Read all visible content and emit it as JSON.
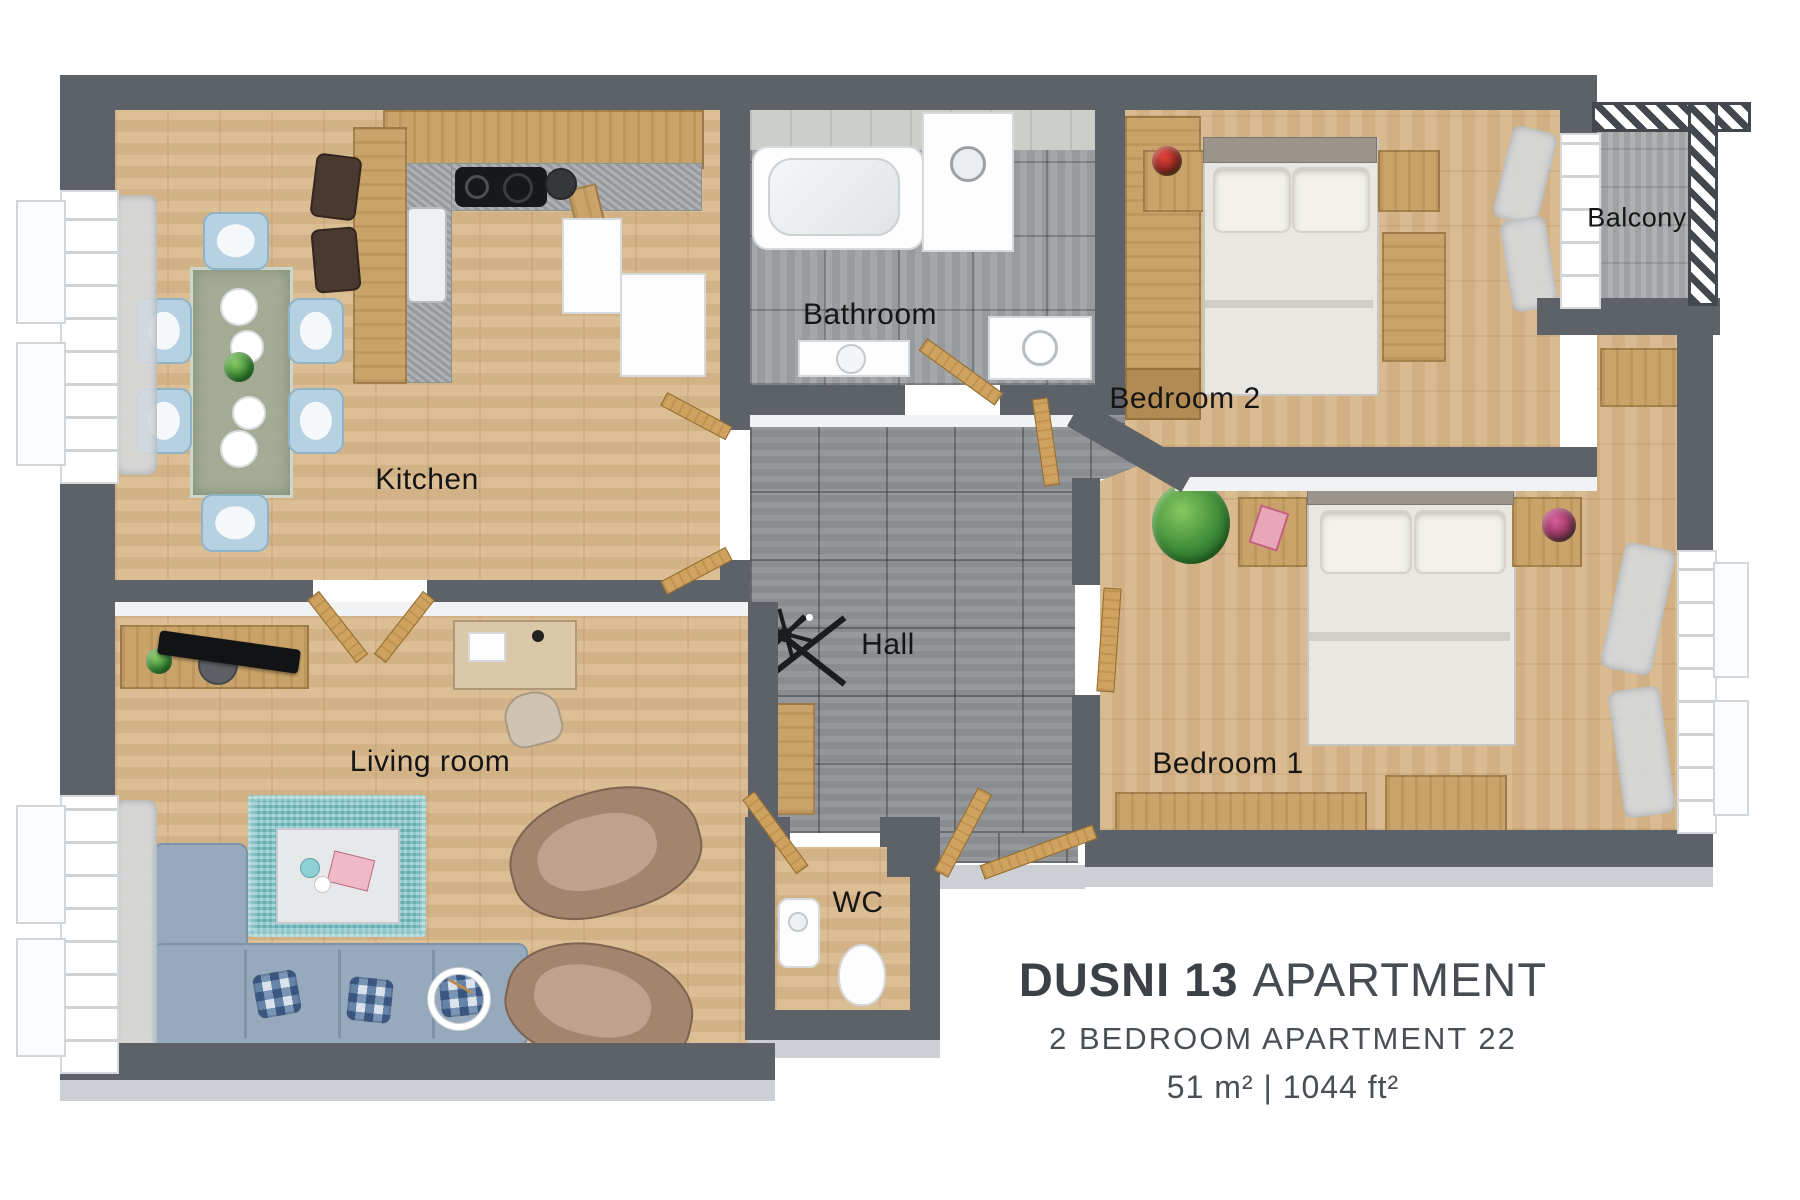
{
  "floorplan": {
    "rooms": [
      {
        "id": "kitchen",
        "label": "Kitchen"
      },
      {
        "id": "bathroom",
        "label": "Bathroom"
      },
      {
        "id": "bedroom-2",
        "label": "Bedroom 2"
      },
      {
        "id": "balcony",
        "label": "Balcony"
      },
      {
        "id": "hall",
        "label": "Hall"
      },
      {
        "id": "living-room",
        "label": "Living room"
      },
      {
        "id": "wc",
        "label": "WC"
      },
      {
        "id": "bedroom-1",
        "label": "Bedroom 1"
      }
    ],
    "colors": {
      "wall": "#5C6268",
      "wood_floor": "#D9B98C",
      "hall_tile": "#8F9296",
      "bath_tile": "#9FA2A4",
      "balcony_floor": "#A8ABAD",
      "rug": "#7FC5CA",
      "sofa": "#96A9BD",
      "door_wood": "#CFA25F",
      "furniture_wood": "#C9A369",
      "label_text": "#151515",
      "title_text": "#41464D"
    }
  },
  "title_block": {
    "title_bold": "DUSNI 13",
    "title_light": "APARTMENT",
    "subtitle": "2 BEDROOM APARTMENT 22",
    "area_metric": "51 m²",
    "area_separator": "|",
    "area_imperial": "1044 ft²"
  }
}
